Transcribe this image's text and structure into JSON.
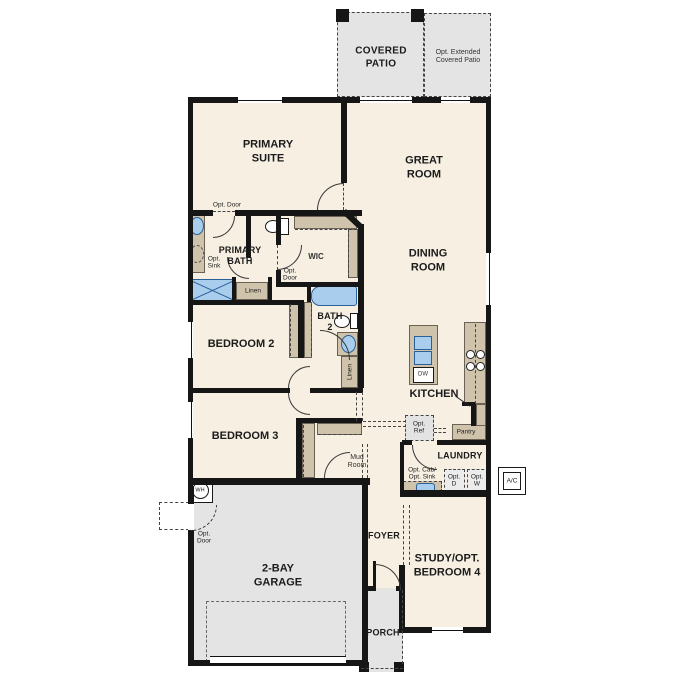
{
  "title": "Single-story home floor plan",
  "labels": {
    "covered_patio": "COVERED\nPATIO",
    "ext_patio": "Opt. Extended\nCovered Patio",
    "primary_suite": "PRIMARY\nSUITE",
    "great_room": "GREAT\nROOM",
    "dining_room": "DINING\nROOM",
    "primary_bath": "PRIMARY\nBATH",
    "wic": "WIC",
    "bath2": "BATH\n2",
    "bedroom2": "BEDROOM 2",
    "bedroom3": "BEDROOM 3",
    "kitchen": "KITCHEN",
    "laundry": "LAUNDRY",
    "mud_room": "Mud\nRoom",
    "foyer": "FOYER",
    "study": "STUDY/OPT.\nBEDROOM 4",
    "garage": "2-BAY\nGARAGE",
    "porch": "PORCH",
    "opt_door": "Opt. Door",
    "opt_door_2line": "Opt.\nDoor",
    "opt_sink": "Opt.\nSink",
    "linen": "Linen",
    "opt_ref": "Opt.\nRef",
    "pantry": "Pantry",
    "opt_cab_sink": "Opt. Cab/\nOpt. Sink",
    "opt_d": "Opt.\nD",
    "opt_w": "Opt.\nW",
    "ac": "A/C",
    "wh": "WH",
    "dw": "DW"
  },
  "colors": {
    "wall": "#161616",
    "interior": "#f6efe2",
    "outdoor": "#e4e4e4",
    "cabinet": "#cfc3ab",
    "fixture": "#a9cdec",
    "fixture_border": "#2b5f97",
    "dashline": "#444444",
    "text": "#1b1b1b"
  }
}
